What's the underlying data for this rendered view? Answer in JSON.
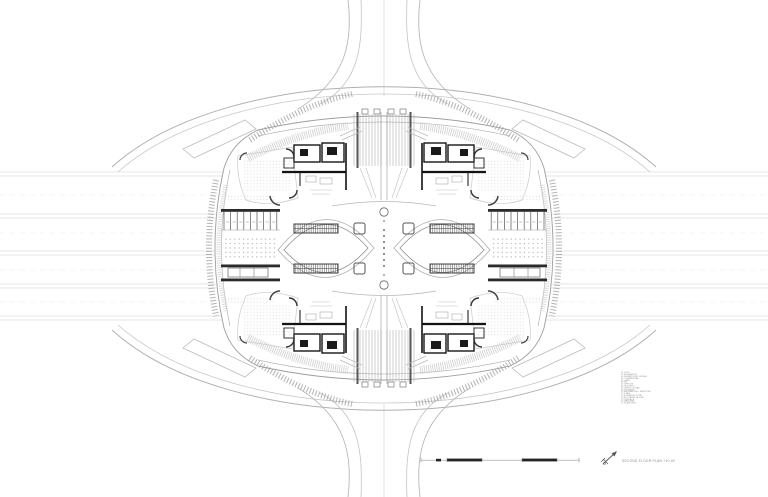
{
  "drawing": {
    "title": "SECOND FLOOR PLAN +10.00",
    "type": "architectural floor plan, symmetric terminal building"
  },
  "legend": {
    "items": [
      "01  VOID",
      "02  ESCALATOR",
      "03  DEPARTURE LOUNGE",
      "04  COMMERCIAL",
      "05  CAFE",
      "06  WC",
      "07  OFFICES",
      "08  SECURITY",
      "09  CHECK-IN HALL",
      "10  STORAGE",
      "11  MECHANICAL / SERVICES",
      "12  STAIR",
      "13  ELEVATOR CORE",
      "14  FOOTBRIDGE LINK",
      "15  TERRACE",
      "16  WALKWAY",
      "17  PLATFORM"
    ]
  },
  "icons": {
    "north_arrow": "north-arrow"
  },
  "colors": {
    "paper": "#ffffff",
    "ink_dark": "#1a1a1a",
    "ink_medium": "#555555",
    "ink_light": "#aaaaaa",
    "ink_faint": "#d9d9d9",
    "annotation_text": "#8a8a8a"
  }
}
